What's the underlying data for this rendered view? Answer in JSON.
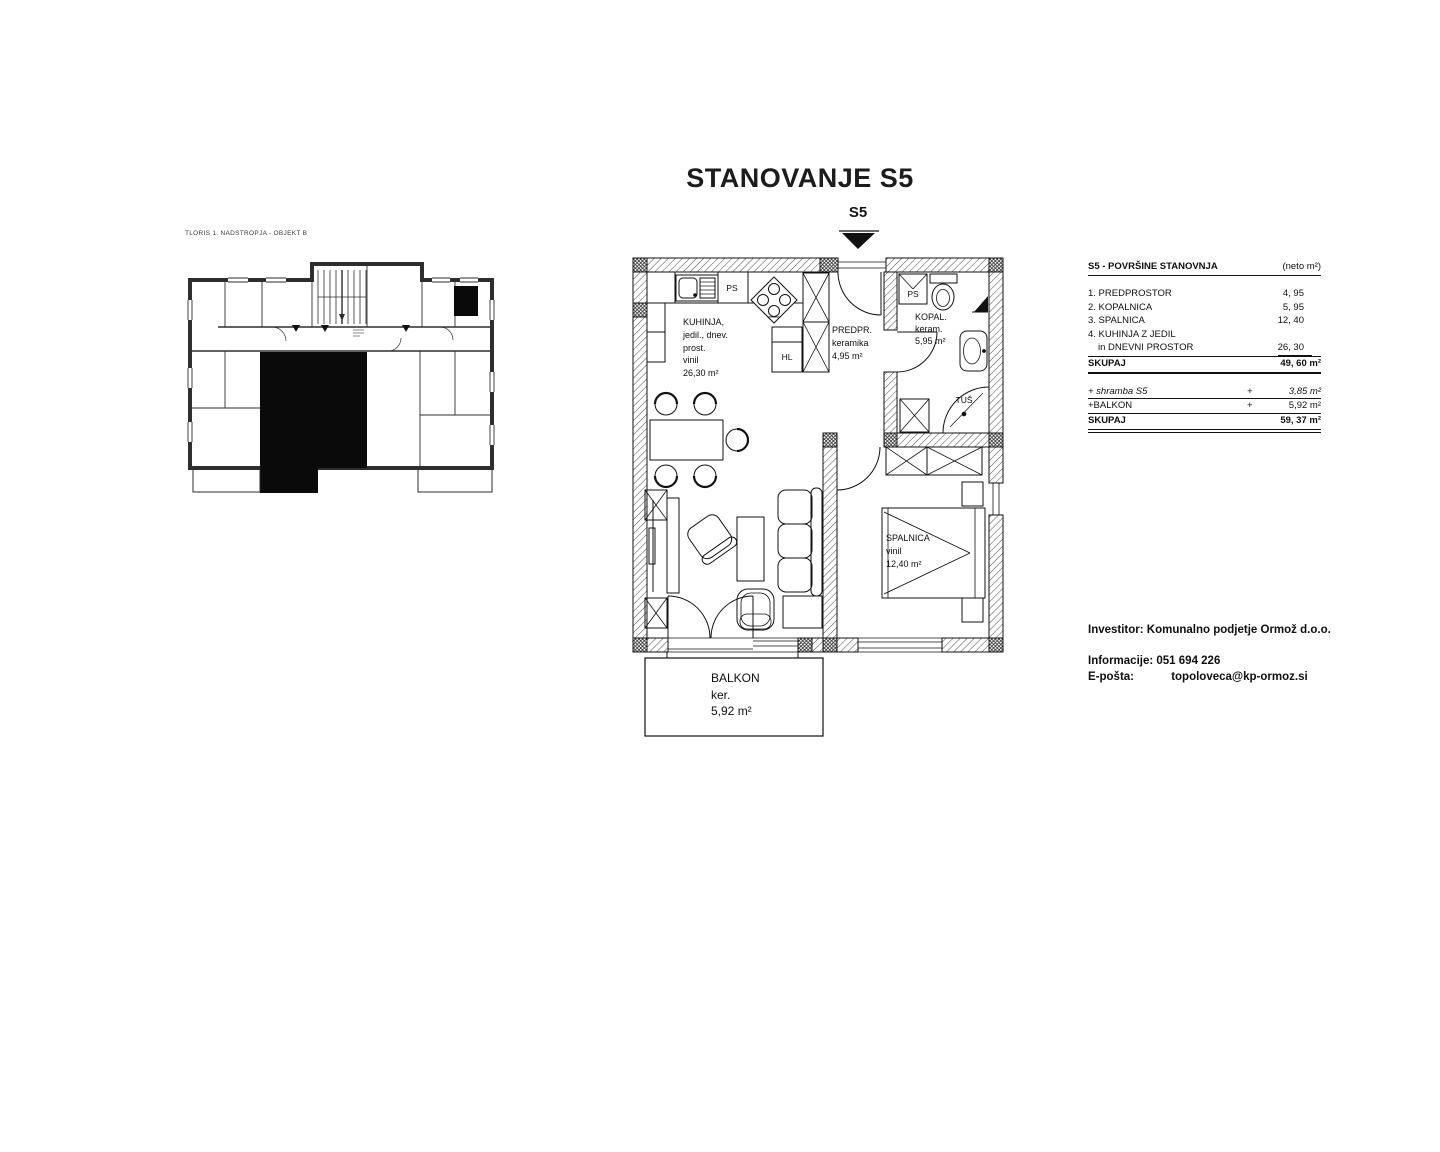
{
  "title": "STANOVANJE S5",
  "entrance_marker": "S5",
  "ink_color": "#111111",
  "overview_plan": {
    "caption": "TLORIS 1. NADSTROPJA - OBJEKT B"
  },
  "main_plan": {
    "rooms": {
      "kuhinja": {
        "lines": [
          "KUHINJA,",
          "jedil., dnev.",
          "prost.",
          "vinil",
          "26,30 m²"
        ]
      },
      "predprostor": {
        "lines": [
          "PREDPR.",
          "keramika",
          "4,95 m²"
        ]
      },
      "kopalnica": {
        "lines": [
          "KOPAL.",
          "keram.",
          "5,95 m²"
        ]
      },
      "spalnica": {
        "lines": [
          "SPALNICA",
          "vinil",
          "12,40 m²"
        ]
      },
      "balkon": {
        "lines": [
          "BALKON",
          "ker.",
          "5,92 m²"
        ]
      }
    },
    "fixtures": {
      "ps_kitchen": "PS",
      "hl": "HL",
      "ps_bath": "PS",
      "tus": "TUŠ"
    }
  },
  "area_table": {
    "title": "S5 - POVRŠINE STANOVNJA",
    "unit_note": "(neto m²)",
    "rows": [
      {
        "label": "1. PREDPROSTOR",
        "value": "4, 95"
      },
      {
        "label": "2. KOPALNICA",
        "value": "5, 95"
      },
      {
        "label": "3. SPALNICA",
        "value": "12, 40"
      },
      {
        "label": "4. KUHINJA Z JEDIL",
        "value": ""
      },
      {
        "label": "in DNEVNI PROSTOR",
        "value": "26, 30"
      }
    ],
    "subtotal": {
      "label": "SKUPAJ",
      "value": "49, 60 m²"
    },
    "extras": [
      {
        "label": "+ shramba S5",
        "sign": "+",
        "value": "3,85 m²"
      },
      {
        "label": "+BALKON",
        "sign": "+",
        "value": "5,92 m²"
      }
    ],
    "total": {
      "label": "SKUPAJ",
      "value": "59, 37 m²"
    }
  },
  "contact": {
    "investor_label": "Investitor:",
    "investor_name": "Komunalno podjetje Ormož d.o.o.",
    "info_label": "Informacije:",
    "phone": "051 694 226",
    "email_label": "E-pošta:",
    "email": "topoloveca@kp-ormoz.si"
  }
}
